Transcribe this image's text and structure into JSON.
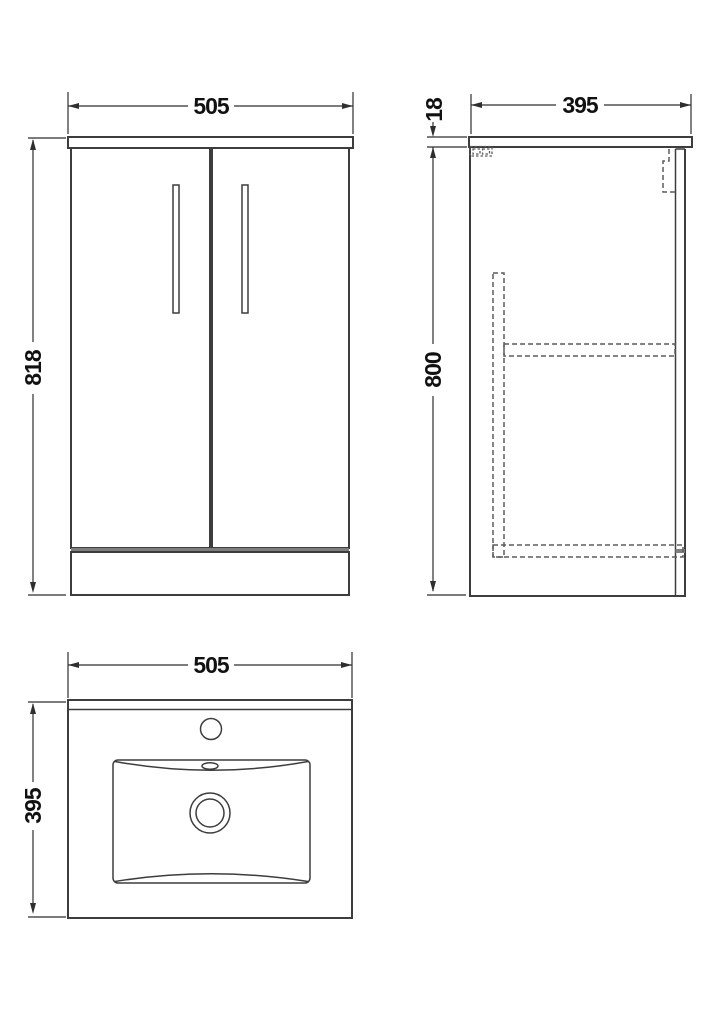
{
  "colors": {
    "background": "#ffffff",
    "line": "#3d3d3d",
    "dim": "#2e2e2e",
    "dashed": "#5c5c5c",
    "band": "#7e7e7e",
    "text": "#111111"
  },
  "views": {
    "front": {
      "width": "505",
      "height": "818"
    },
    "side": {
      "depth": "395",
      "top_thickness": "18",
      "body_height": "800"
    },
    "plan": {
      "width": "505",
      "depth": "395"
    }
  }
}
